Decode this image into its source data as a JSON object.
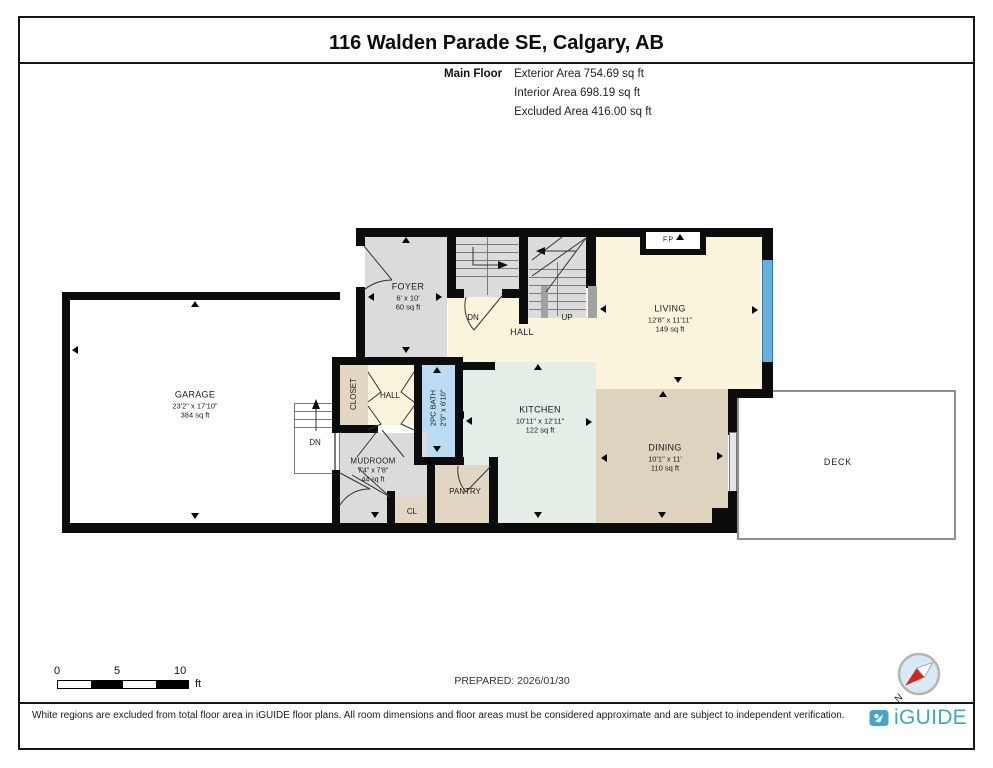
{
  "header": {
    "title": "116 Walden Parade SE, Calgary, AB",
    "floor_label": "Main Floor",
    "exterior": "Exterior Area 754.69 sq ft",
    "interior": "Interior Area 698.19 sq ft",
    "excluded": "Excluded Area 416.00 sq ft"
  },
  "rooms": {
    "foyer": {
      "name": "FOYER",
      "dims": "6' x 10'",
      "area": "60 sq ft"
    },
    "garage": {
      "name": "GARAGE",
      "dims": "23'2\" x 17'10\"",
      "area": "384 sq ft"
    },
    "living": {
      "name": "LIVING",
      "dims": "12'8\" x 11'11\"",
      "area": "149 sq ft"
    },
    "kitchen": {
      "name": "KITCHEN",
      "dims": "10'11\" x 12'11\"",
      "area": "122 sq ft"
    },
    "dining": {
      "name": "DINING",
      "dims": "10'1\" x 11'",
      "area": "110 sq ft"
    },
    "mudroom": {
      "name": "MUDROOM",
      "dims": "7'4\" x 7'8\"",
      "area": "44 sq ft"
    },
    "bath": {
      "name": "2PC BATH",
      "dims": "2'9\" x 6'10\""
    },
    "hall_main": {
      "name": "HALL"
    },
    "hall_small": {
      "name": "HALL"
    },
    "closet": {
      "name": "CLOSET"
    },
    "cl": {
      "name": "CL"
    },
    "pantry": {
      "name": "PANTRY"
    },
    "deck": {
      "name": "DECK"
    },
    "fireplace": {
      "name": "F.P"
    }
  },
  "stairs": {
    "down": "DN",
    "up": "UP",
    "garage_down": "DN"
  },
  "scale_bar": {
    "t0": "0",
    "t5": "5",
    "t10": "10",
    "unit": "ft"
  },
  "prepared": "PREPARED: 2026/01/30",
  "compass": {
    "north": "N"
  },
  "footer": {
    "disclaimer": "White regions are excluded from total floor area in iGUIDE floor plans. All room dimensions and floor areas must be considered approximate and are subject to independent verification.",
    "brand": "iGUIDE"
  },
  "colors": {
    "wall": "#0c0c0c",
    "hall_cream": "#fbf4dc",
    "room_gray": "#dbdbdb",
    "tan": "#e2d7c2",
    "dining_tan": "#ded3bf",
    "kitchen_green": "#e4ede6",
    "bath_blue": "#b9dcf2",
    "window_blue": "#67b0de",
    "brand_blue": "#45a5c9",
    "compass_red": "#d3261a"
  }
}
